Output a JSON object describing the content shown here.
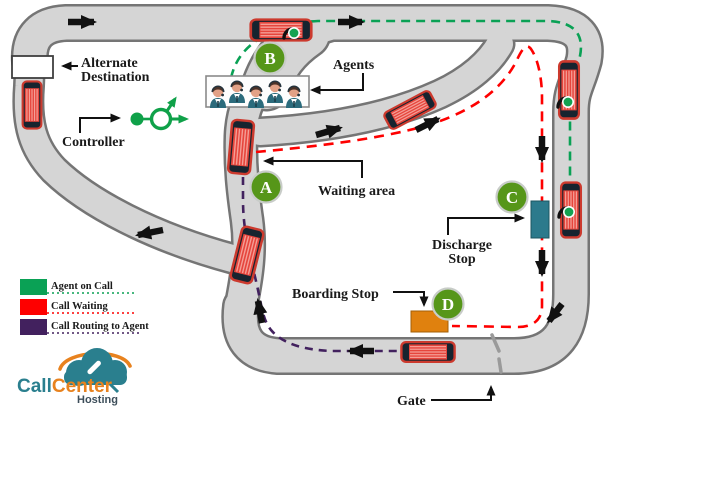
{
  "labels": {
    "alternate_destination_line1": "Alternate",
    "alternate_destination_line2": "Destination",
    "controller": "Controller",
    "agents": "Agents",
    "waiting_area": "Waiting area",
    "discharge_line1": "Discharge",
    "discharge_line2": "Stop",
    "boarding_stop": "Boarding Stop",
    "gate": "Gate"
  },
  "nodes": {
    "a": "A",
    "b": "B",
    "c": "C",
    "d": "D"
  },
  "legend": {
    "items": [
      {
        "label": "Agent on Call",
        "color": "#0aa155"
      },
      {
        "label": "Call Waiting",
        "color": "#fe0000"
      },
      {
        "label": "Call Routing to Agent",
        "color": "#42215e"
      }
    ]
  },
  "logo": {
    "call": "Call",
    "center": "Center",
    "hosting": "Hosting"
  },
  "icons": {
    "bus": "bus-icon",
    "agent": "agent-person-icon",
    "on_call": "phone-call-green-dot-icon",
    "controller": "controller-branch-icon",
    "logo_cloud": "cloud-phone-logo-icon",
    "arrow": "direction-arrow-icon",
    "gate": "gate-marks-icon"
  },
  "colors": {
    "road_fill": "#d5d5d5",
    "road_casing": "#757575",
    "node_green": "#569619",
    "discharge_stop": "#2c7a8c",
    "boarding_stop": "#e0810e",
    "bus_red": "#e6453c",
    "controller_green": "#0fa149"
  }
}
